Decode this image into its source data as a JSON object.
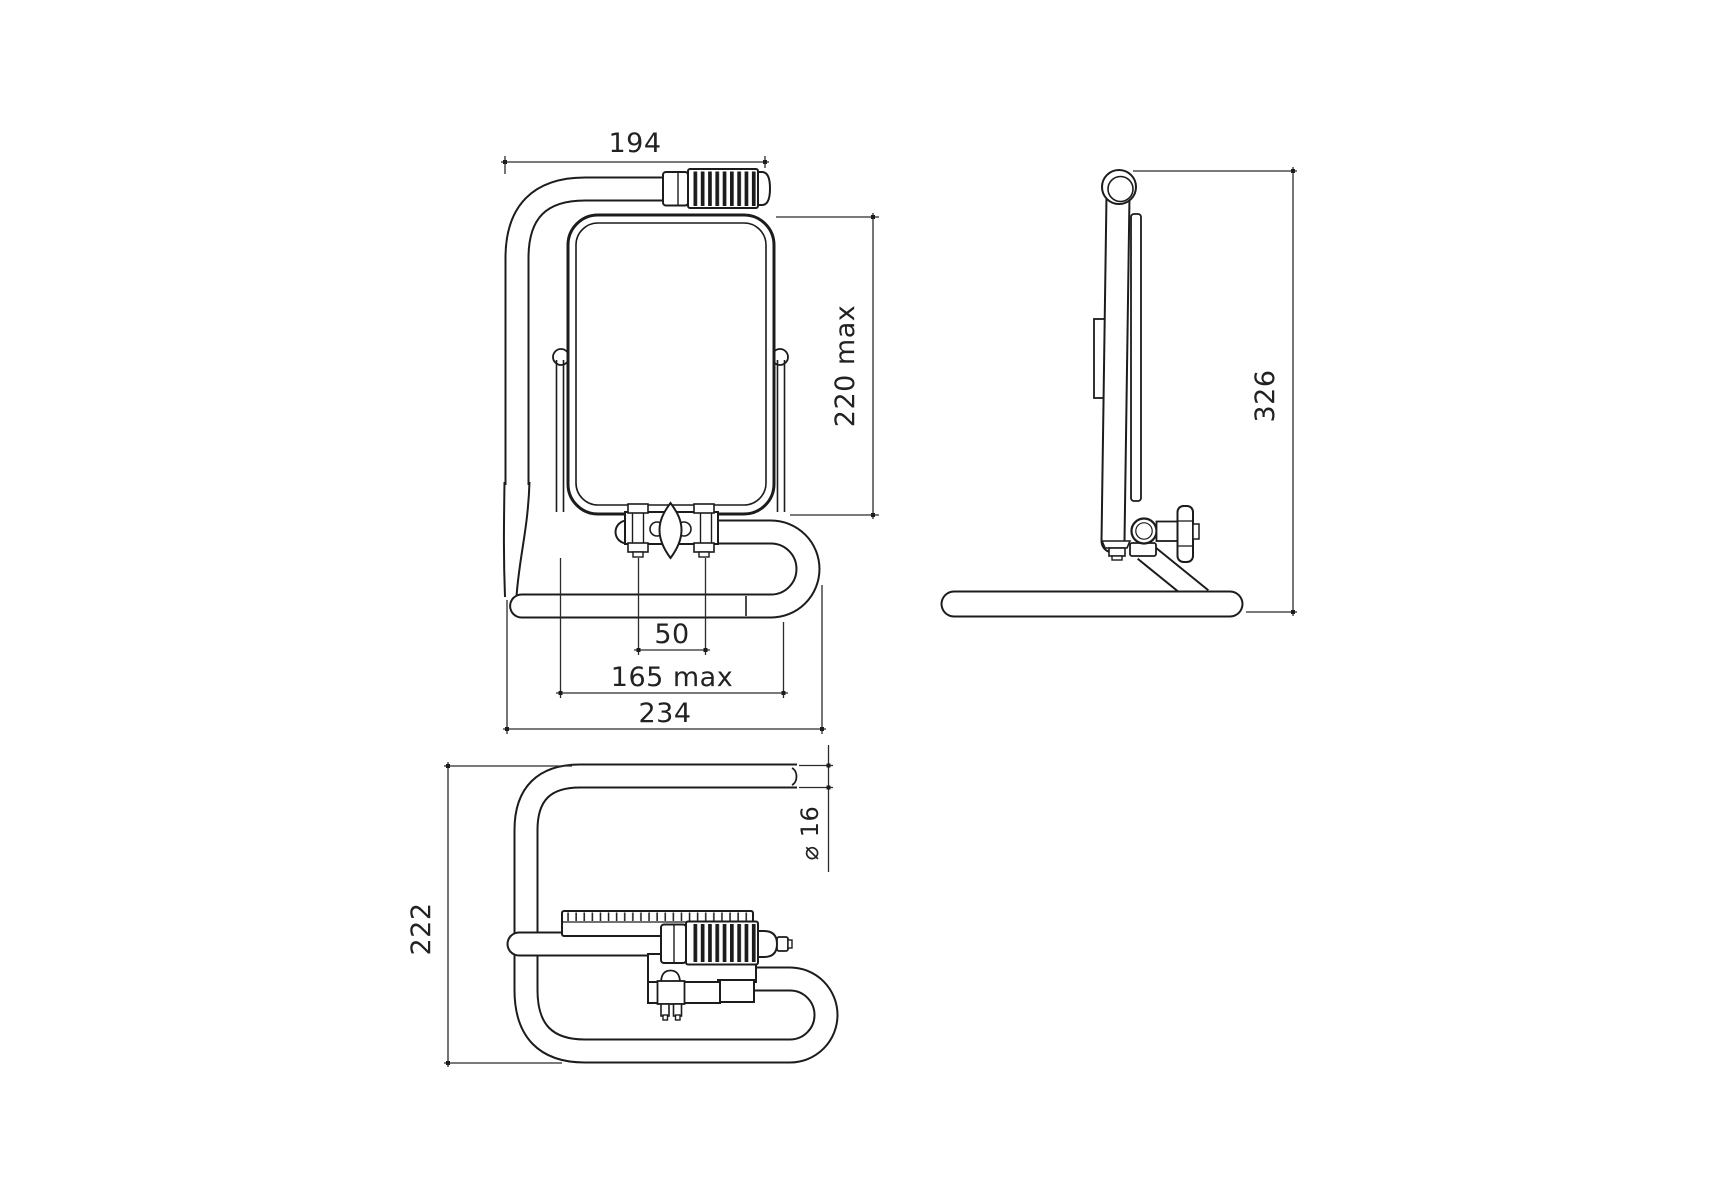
{
  "style": {
    "background": "#ffffff",
    "ink": "#1c1c1c",
    "dim_line": "#2b2b2b",
    "dim_text": "#222222"
  },
  "dims": {
    "frame_width": "194",
    "lamp_height": "220 max",
    "clamp_bolt_spacing": "50",
    "clamp_width": "165 max",
    "overall_width": "234",
    "overall_height": "326",
    "base_depth": "222",
    "tube_diameter": "⌀ 16"
  }
}
